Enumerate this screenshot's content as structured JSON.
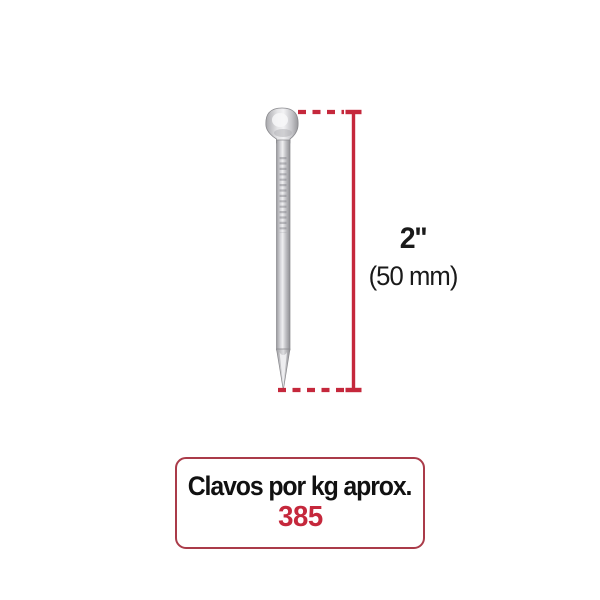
{
  "dimension": {
    "inches_label": "2''",
    "mm_label": "(50 mm)"
  },
  "info_box": {
    "title": "Clavos por kg aprox.",
    "value": "385"
  },
  "icons": {
    "nail": "nail-product-image",
    "dimension_lines": "measurement-extent-lines"
  },
  "colors": {
    "background": "#ffffff",
    "accent_red": "#c5283c",
    "box_border_red": "#aa3b49",
    "text_black": "#1a1a1a",
    "nail_edge_dark": "#939397",
    "nail_mid": "#cdcdd1",
    "nail_highlight": "#efeff1"
  }
}
